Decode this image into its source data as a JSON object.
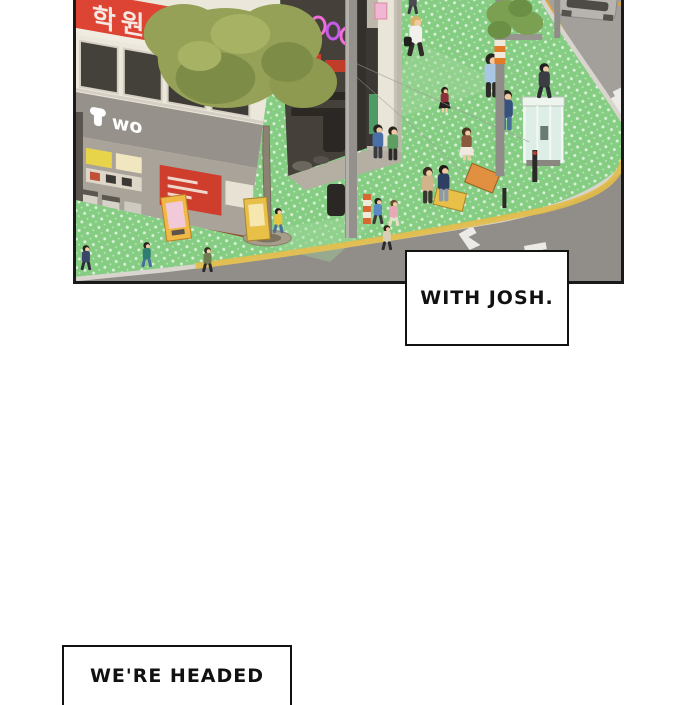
{
  "comic": {
    "speech_boxes": [
      {
        "id": "box-with-josh",
        "text": "WITH JOSH."
      },
      {
        "id": "box-were-headed",
        "text": "WE'RE HEADED"
      }
    ],
    "panel": {
      "description": "Aerial view of a city street corner: pedestrians on a green polka-dot sidewalk, storefronts with Korean signage, a zebra crosswalk, a phone booth, traffic poles and a passing car",
      "signs": {
        "academy_sign_text": "학원",
        "storefront_logo_text": "wo"
      },
      "palette": {
        "sidewalk_green": "#86cd84",
        "sidewalk_dot": "#eaf6e8",
        "road_gray": "#a39f9b",
        "crosswalk_white": "#edebe7",
        "academy_sign_red": "#dd4434",
        "storefront_band_gray": "#96928b",
        "awning_brown": "#a8693a",
        "tree_olive": "#94a156",
        "tactile_paving_yellow": "#e3bd4a",
        "phone_booth_mint": "#dceee6",
        "panel_border_black": "#1a1a1a"
      }
    }
  }
}
